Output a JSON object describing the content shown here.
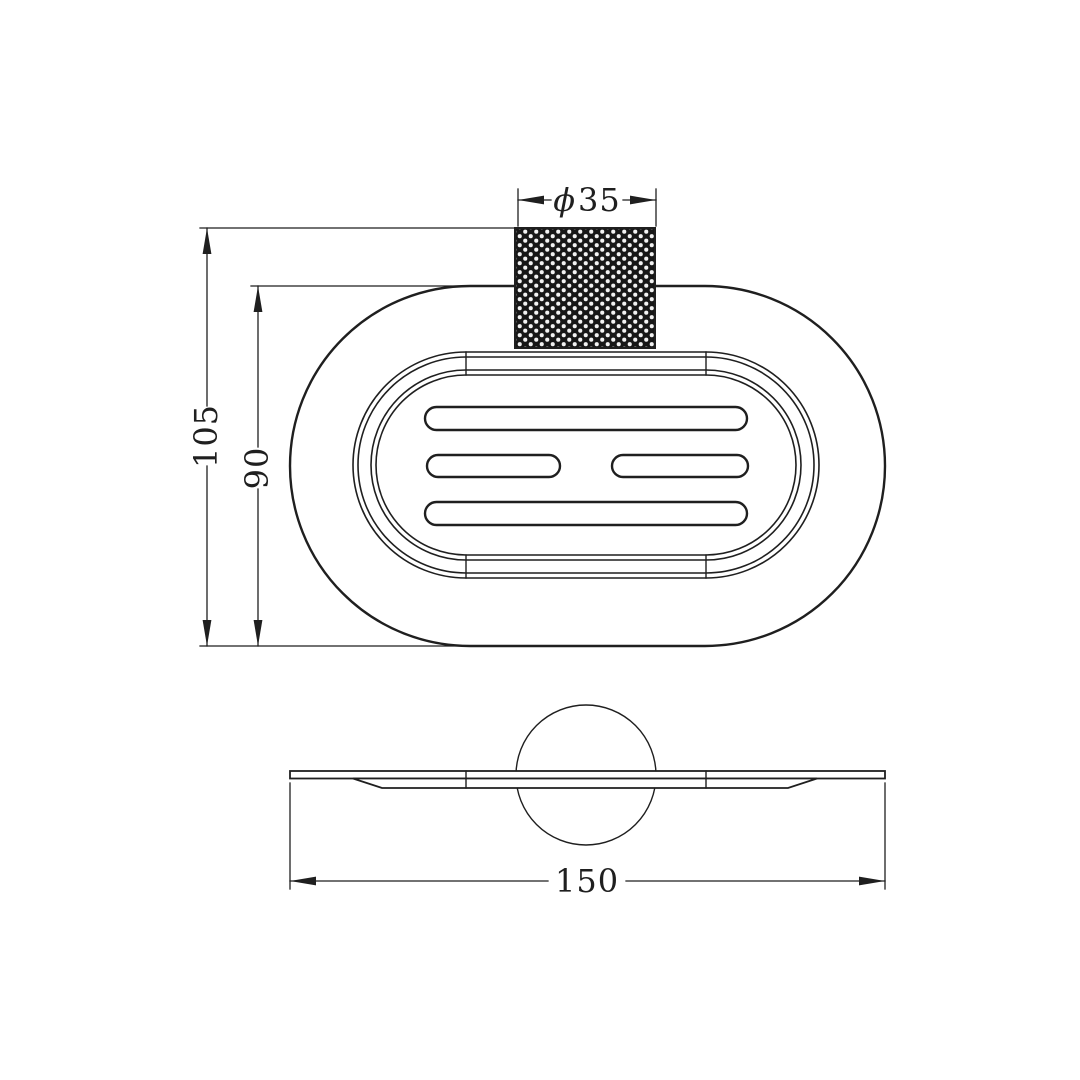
{
  "drawing": {
    "background": "#ffffff",
    "line_color": "#1f1f1f",
    "dimensions": {
      "post_diameter_symbol": "ϕ",
      "post_diameter_value": "35",
      "overall_height": "105",
      "body_height": "90",
      "overall_width": "150"
    }
  }
}
